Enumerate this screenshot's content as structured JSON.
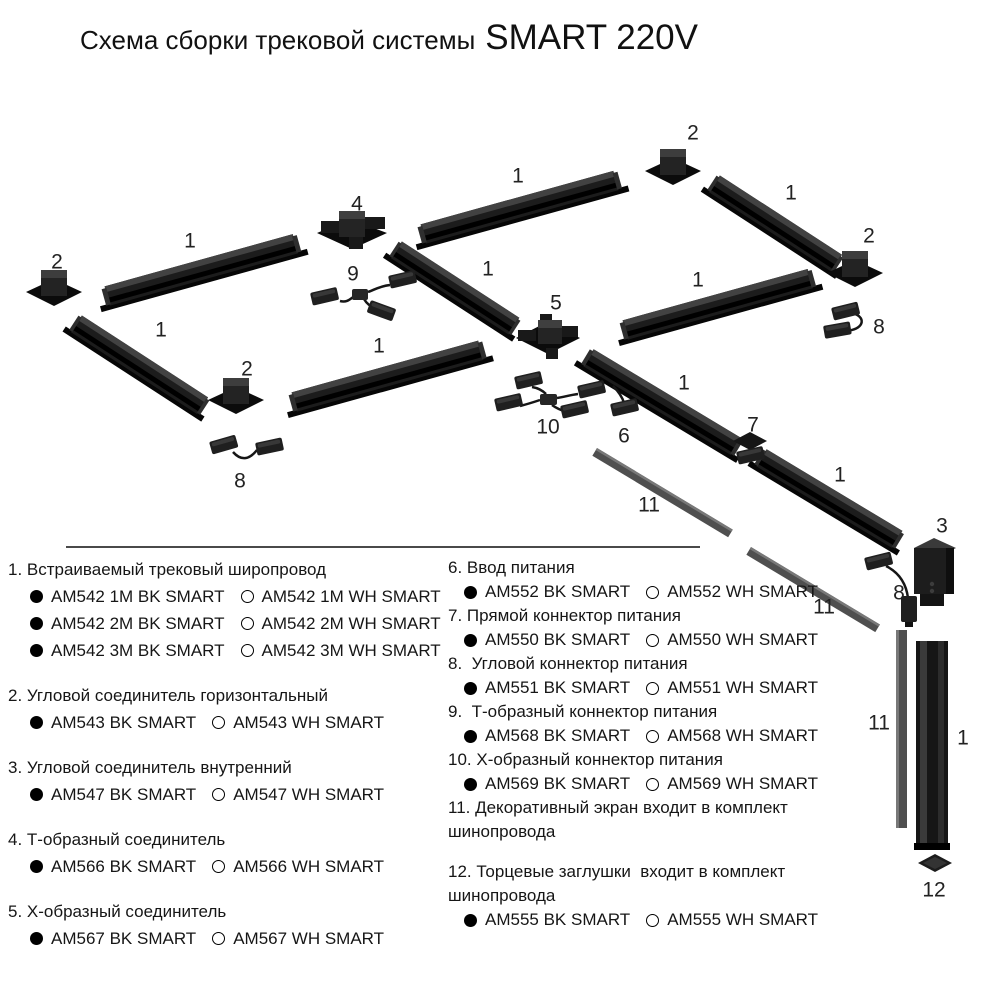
{
  "title": {
    "prefix": "Схема сборки трековой системы",
    "brand": "SMART 220V"
  },
  "colors": {
    "track": "#1c1c1c",
    "screen": "#4f4f4f",
    "text": "#161616",
    "background": "#ffffff"
  },
  "diagram": {
    "callouts": {
      "n1": "1",
      "n2": "2",
      "n3": "3",
      "n4": "4",
      "n5": "5",
      "n6": "6",
      "n7": "7",
      "n8": "8",
      "n9": "9",
      "n10": "10",
      "n11": "11",
      "n12": "12"
    }
  },
  "legend": {
    "left": [
      {
        "title": "1. Встраиваемый трековый широпровод",
        "variants": [
          {
            "bk": "AM542 1M BK SMART",
            "wh": "AM542 1M WH SMART"
          },
          {
            "bk": "AM542 2M BK SMART",
            "wh": "AM542 2M WH SMART"
          },
          {
            "bk": "AM542 3M BK SMART",
            "wh": "AM542 3M WH SMART"
          }
        ]
      },
      {
        "title": "2. Угловой соединитель горизонтальный",
        "variants": [
          {
            "bk": "AM543 BK SMART",
            "wh": "AM543 WH SMART"
          }
        ]
      },
      {
        "title": "3. Угловой соединитель внутренний",
        "variants": [
          {
            "bk": "AM547 BK SMART",
            "wh": "AM547 WH SMART"
          }
        ]
      },
      {
        "title": "4. Т-образный соединитель",
        "variants": [
          {
            "bk": "AM566 BK SMART",
            "wh": "AM566 WH SMART"
          }
        ]
      },
      {
        "title": "5. Х-образный соединитель",
        "variants": [
          {
            "bk": "AM567 BK SMART",
            "wh": "AM567 WH SMART"
          }
        ]
      }
    ],
    "right": [
      {
        "title": "6. Ввод питания",
        "variants": [
          {
            "bk": "AM552 BK SMART",
            "wh": "AM552 WH SMART"
          }
        ]
      },
      {
        "title": "7. Прямой коннектор питания",
        "variants": [
          {
            "bk": "AM550 BK SMART",
            "wh": "AM550 WH SMART"
          }
        ]
      },
      {
        "title": "8.  Угловой коннектор питания",
        "variants": [
          {
            "bk": "AM551 BK SMART",
            "wh": "AM551 WH SMART"
          }
        ]
      },
      {
        "title": "9.  Т-образный коннектор питания",
        "variants": [
          {
            "bk": "AM568 BK SMART",
            "wh": "AM568 WH SMART"
          }
        ]
      },
      {
        "title": "10. Х-образный коннектор питания",
        "variants": [
          {
            "bk": "AM569 BK SMART",
            "wh": "AM569 WH SMART"
          }
        ]
      },
      {
        "title": "11. Декоративный экран входит в комплект шинопровода",
        "variants": []
      },
      {
        "title": "12. Торцевые заглушки  входит в комплект шинопровода",
        "variants": [
          {
            "bk": "AM555 BK SMART",
            "wh": "AM555 WH SMART"
          }
        ]
      }
    ]
  }
}
